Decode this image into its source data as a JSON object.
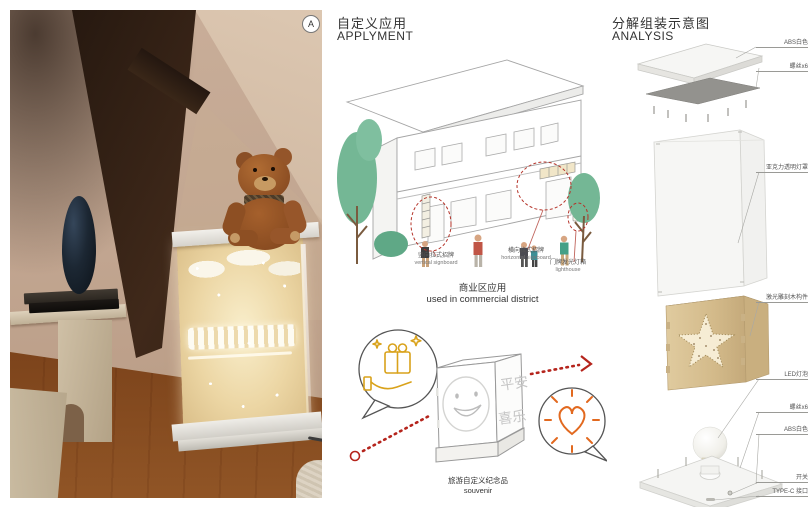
{
  "photo": {
    "badge_label": "A",
    "description": "attic interior with teddy bear on glowing laser-engraved wooden light box"
  },
  "applyment": {
    "title_zh": "自定义应用",
    "title_en": "APPLYMENT",
    "labels": {
      "vertical": {
        "zh": "竖向拉式招牌",
        "en": "vertical signboard"
      },
      "horizontal": {
        "zh": "横向拉式招牌",
        "en": "horizontal signboard"
      },
      "lighthouse": {
        "zh": "门牌发光灯箱",
        "en": "lighthouse"
      }
    },
    "commercial_caption": {
      "zh": "商业区应用",
      "en": "used in commercial district"
    },
    "cube": {
      "side_text_1": "平安",
      "side_text_2": "喜乐"
    },
    "souvenir_caption": {
      "zh": "旅游自定义纪念品",
      "en": "souvenir"
    }
  },
  "analysis": {
    "title_zh": "分解组装示意图",
    "title_en": "ANALYSIS",
    "labels": [
      {
        "text": "ABS白色"
      },
      {
        "text": "螺丝x6"
      },
      {
        "text": "亚克力透明灯罩"
      },
      {
        "text": "激光雕刻木构件"
      },
      {
        "text": "LED灯泡"
      },
      {
        "text": "螺丝x6"
      },
      {
        "text": "ABS白色"
      },
      {
        "text": "开关"
      },
      {
        "text": "TYPE-C 接口"
      }
    ]
  },
  "colors": {
    "accent_red": "#b5342a",
    "gold": "#d9a21b",
    "orange": "#e2691f",
    "tree_green": "#74b795",
    "line_gray": "#9b9b9b"
  }
}
